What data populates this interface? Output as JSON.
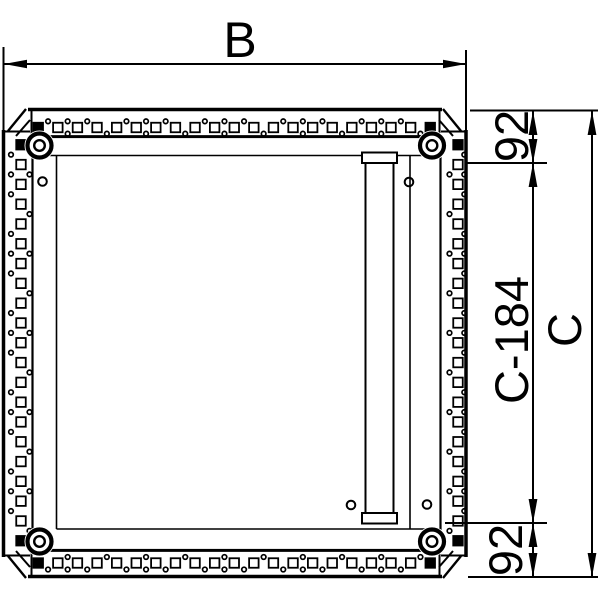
{
  "drawing": {
    "type": "technical-dimension-drawing",
    "subject": "enclosure-gland-plate",
    "paper_color": "#ffffff",
    "ink_color": "#000000"
  },
  "labels": {
    "b": "B",
    "c": "C",
    "offset_top": "92",
    "span_middle": "C-184",
    "offset_bottom": "92"
  }
}
